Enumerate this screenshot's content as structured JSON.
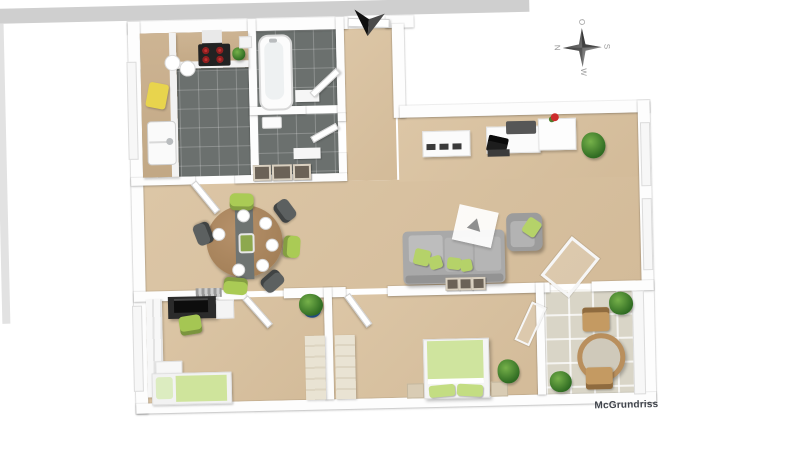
{
  "page": {
    "background": "#ffffff",
    "type": "3d-floor-plan"
  },
  "watermark": {
    "label": "McGrundriss"
  },
  "compass": {
    "top": "O",
    "right": "S",
    "bottom": "W",
    "left": "N"
  },
  "entrance": {
    "marker": "entrance-arrow"
  },
  "colors": {
    "carpet": "#d8c2a1",
    "kitchen_bath_tile": "#6b706e",
    "balcony_tile": "#d9d5c7",
    "wall": "#fdfdfd",
    "wall_front_face": "#cfcfcf",
    "accent_green": "#aacb55",
    "sofa_gray": "#a9a9a9",
    "wood": "#b98f63",
    "stove_red": "#c03030"
  },
  "rooms": [
    {
      "name": "kitchen",
      "floor": "dark-tile"
    },
    {
      "name": "bathroom",
      "floor": "dark-tile"
    },
    {
      "name": "wc",
      "floor": "dark-tile"
    },
    {
      "name": "entrance-hall",
      "floor": "carpet"
    },
    {
      "name": "dining-area",
      "floor": "carpet"
    },
    {
      "name": "living-area",
      "floor": "carpet"
    },
    {
      "name": "office-room",
      "floor": "carpet"
    },
    {
      "name": "bedroom",
      "floor": "carpet"
    },
    {
      "name": "balcony",
      "floor": "stone-tile"
    }
  ],
  "furniture": {
    "kitchen": [
      "l-counter",
      "cooktop",
      "sink",
      "plates",
      "coffee-machine",
      "cutting-board",
      "herb-pot"
    ],
    "bathroom": [
      "bathtub",
      "bath-mat"
    ],
    "wc": [
      "wash-basin",
      "mat"
    ],
    "dining": [
      "round-table",
      "table-runner",
      "plates",
      "green-chairs",
      "gray-chairs",
      "picture-frames"
    ],
    "living": [
      "tv-lowboard",
      "desk",
      "laptop",
      "desk-pad",
      "cabinet",
      "flower-vase",
      "palm-plant",
      "corner-sofa",
      "green-pillows",
      "armchair",
      "rug",
      "picture-frames",
      "glass-balcony-door"
    ],
    "office": [
      "wardrobe",
      "desk-with-monitor",
      "office-chair",
      "drawer-unit",
      "single-bed",
      "radiator",
      "potted-plant"
    ],
    "bedroom": [
      "double-bed",
      "nightstands",
      "wardrobe",
      "potted-plant",
      "glass-balcony-door"
    ],
    "balcony": [
      "round-table",
      "wooden-chairs",
      "bushes"
    ]
  }
}
